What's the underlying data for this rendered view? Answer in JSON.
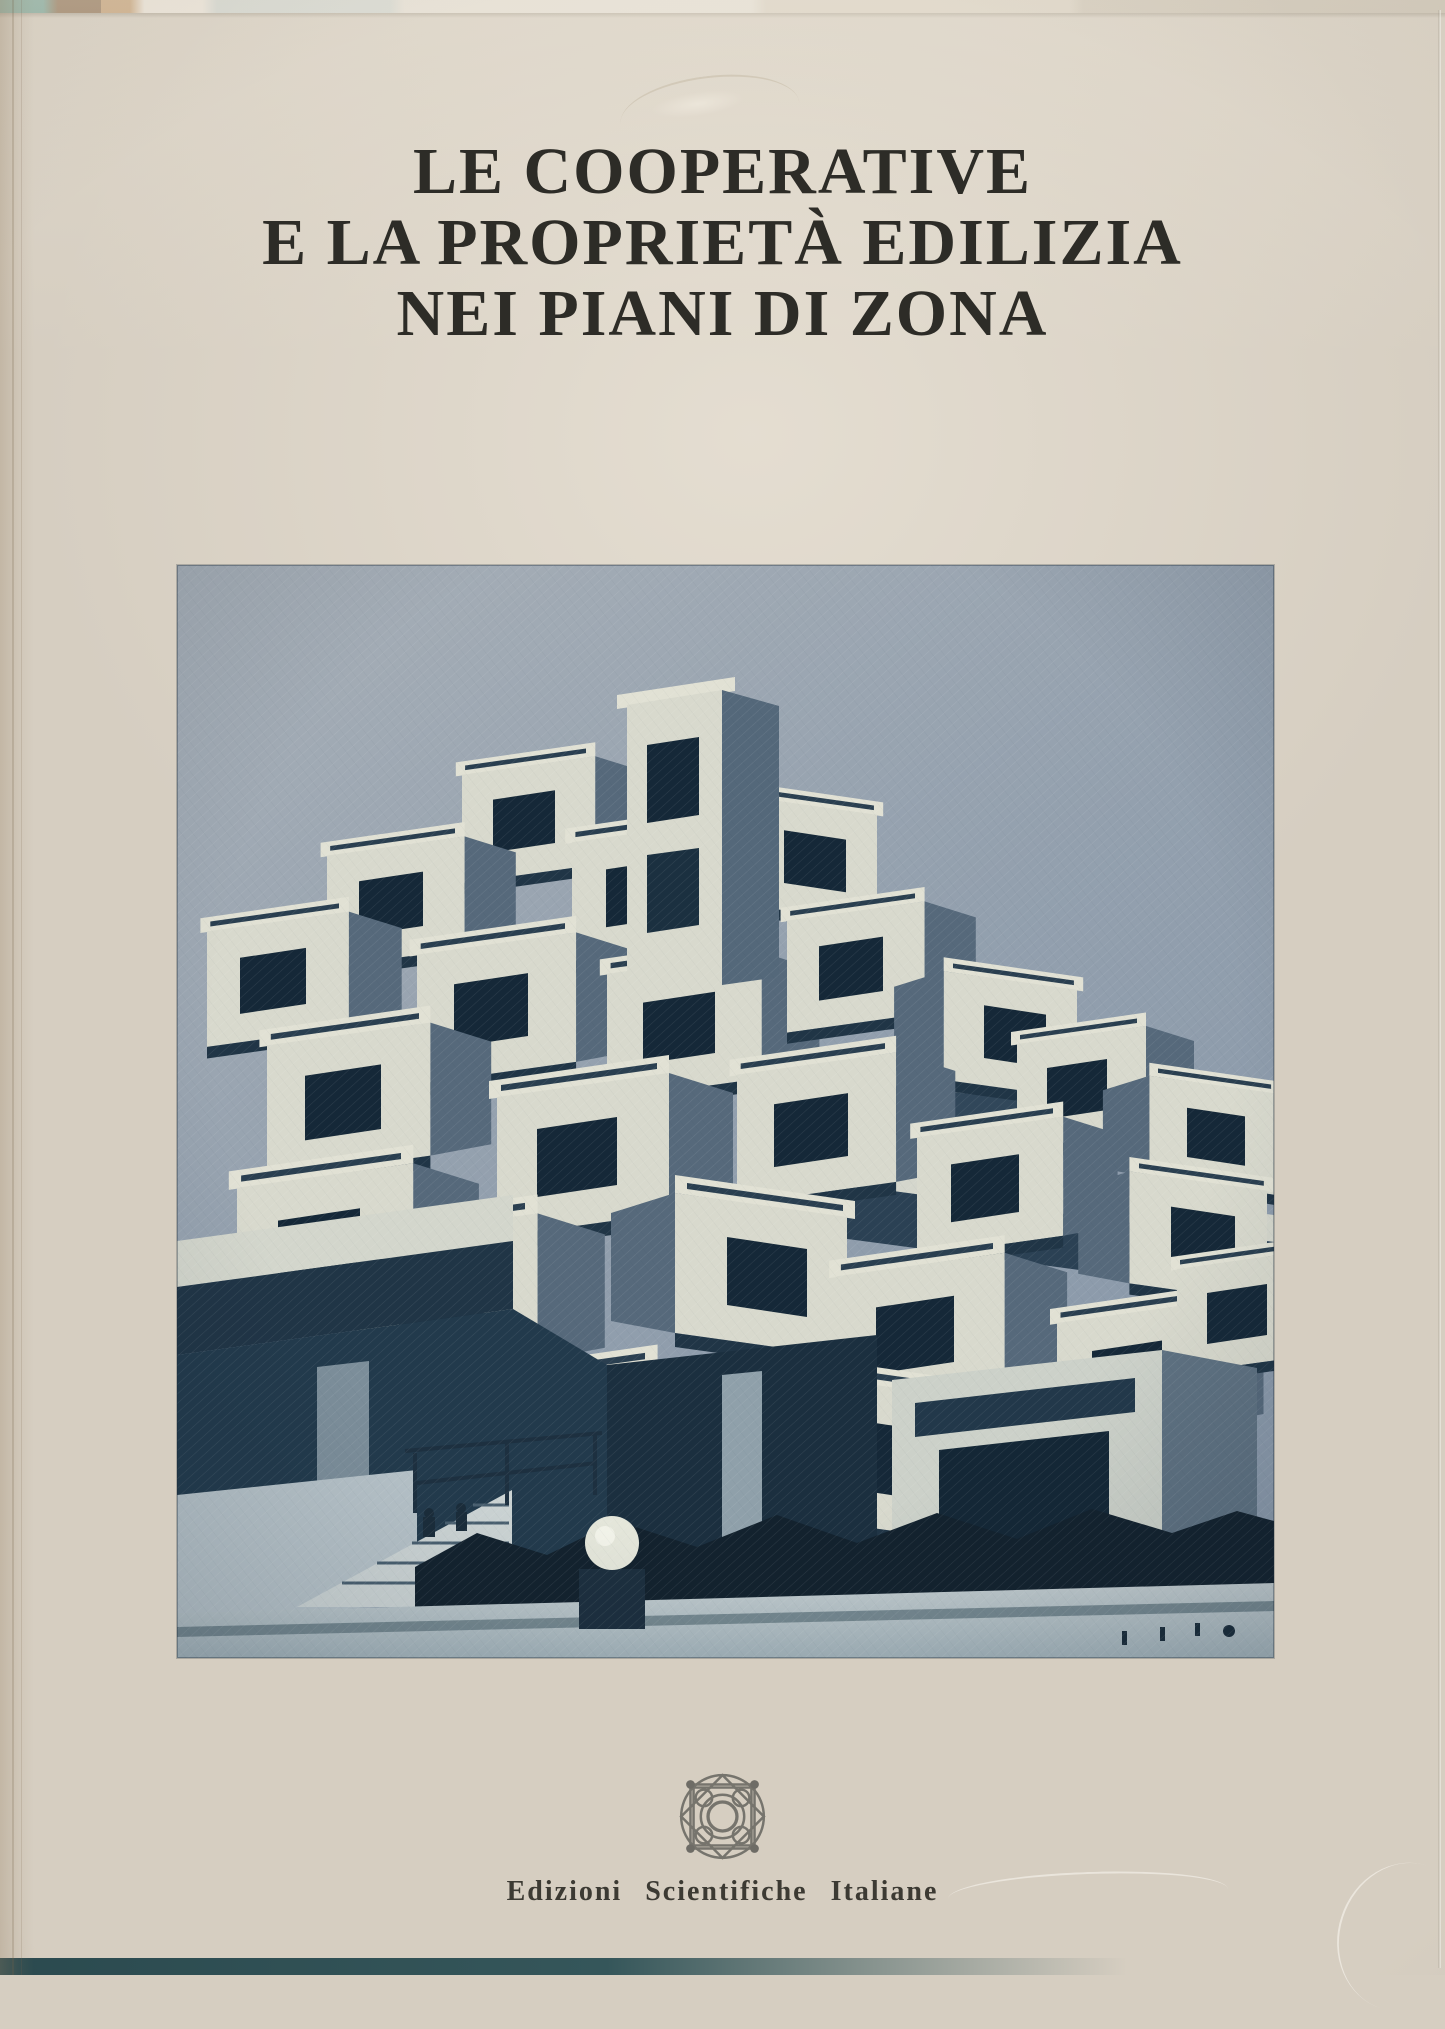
{
  "cover": {
    "title_lines": [
      "LE COOPERATIVE",
      "E LA PROPRIETÀ EDILIZIA",
      "NEI PIANI DI ZONA"
    ],
    "publisher": "Edizioni Scientifiche Italiane",
    "photo": {
      "name": "habitat-67-photo",
      "style": "blue-duotone-halftone"
    },
    "logo": {
      "name": "esi-rosette-logo"
    },
    "colors": {
      "cover_background": "#d6cec1",
      "title_text": "#2d2c27",
      "publisher_text": "#3c3a33",
      "photo_sky": "#97a2b0",
      "photo_light_faces": "#d8d9cd",
      "photo_deep_shadow": "#1b2f3f",
      "photo_plaza": "#b9c4c9",
      "table_surface_teal": "#2b4a4f"
    }
  }
}
